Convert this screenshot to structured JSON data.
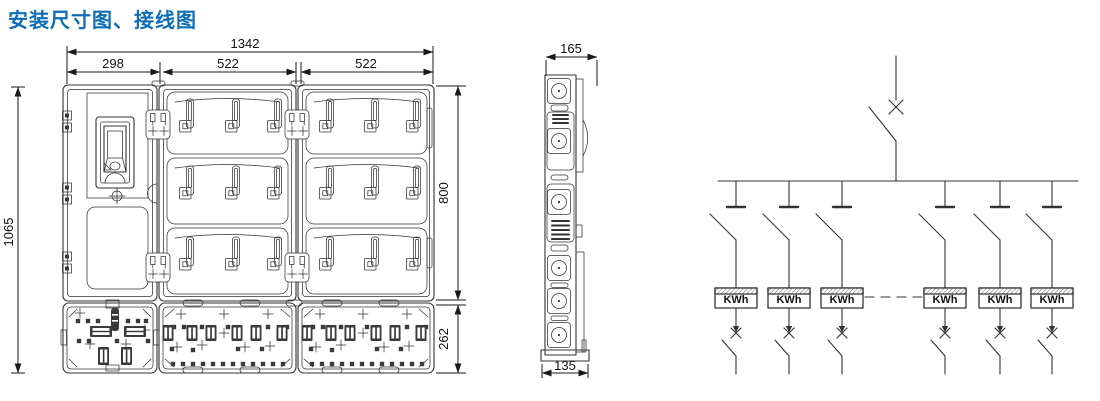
{
  "title": "安装尺寸图、接线图",
  "colors": {
    "title_blue": "#0d6db8",
    "line": "#333333",
    "dark_fill": "#3a3a3a"
  },
  "front_view": {
    "dim_total_width": "1342",
    "dim_left_width": "298",
    "dim_mid_width": "522",
    "dim_right_width": "522",
    "dim_total_height": "1065",
    "dim_body_height": "800",
    "dim_terminal_height": "262"
  },
  "side_view": {
    "dim_depth_top": "165",
    "dim_depth_bottom": "135"
  },
  "wiring_diagram": {
    "meters": [
      {
        "label": "KWh"
      },
      {
        "label": "KWh"
      },
      {
        "label": "KWh"
      },
      {
        "label": "KWh"
      },
      {
        "label": "KWh"
      },
      {
        "label": "KWh"
      }
    ]
  }
}
